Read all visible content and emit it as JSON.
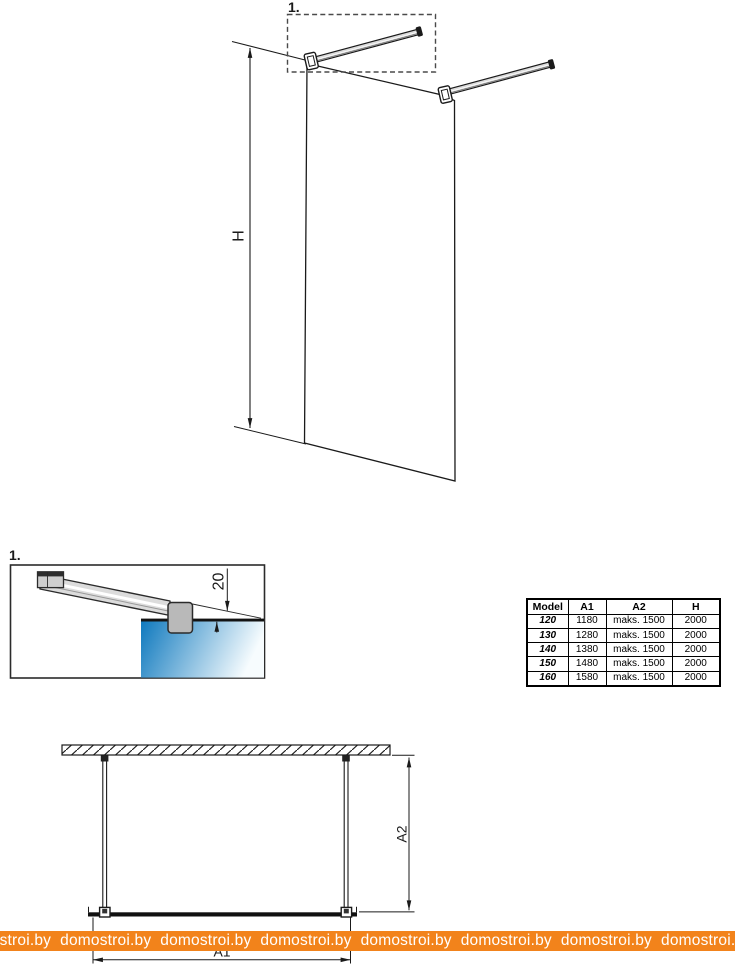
{
  "iso_view": {
    "callout": "1.",
    "height_dim_label": "H"
  },
  "detail_view": {
    "callout": "1.",
    "offset_dim_value": "20"
  },
  "plan_view": {
    "width_dim_label": "A1",
    "depth_dim_label": "A2"
  },
  "spec_table": {
    "headers": [
      "Model",
      "A1",
      "A2",
      "H"
    ],
    "rows": [
      [
        "120",
        "1180",
        "maks. 1500",
        "2000"
      ],
      [
        "130",
        "1280",
        "maks. 1500",
        "2000"
      ],
      [
        "140",
        "1380",
        "maks. 1500",
        "2000"
      ],
      [
        "150",
        "1480",
        "maks. 1500",
        "2000"
      ],
      [
        "160",
        "1580",
        "maks. 1500",
        "2000"
      ]
    ]
  },
  "watermark": {
    "site": "domostroi.by",
    "display_line": "domostroi.by  domostroi.by  domostroi.by  domostroi.by  domostroi.by  domostroi.by  domostroi.by  domostroi.by",
    "bar_color": "#F2831B",
    "text_color": "#FFFFFF"
  },
  "colors": {
    "line": "#1A1A1A",
    "glass_gradient_start": "#0F79BE",
    "glass_gradient_end": "#F7FCFE",
    "metal_bar": "#DCDCDC",
    "clamp": "#B9B9B9"
  }
}
